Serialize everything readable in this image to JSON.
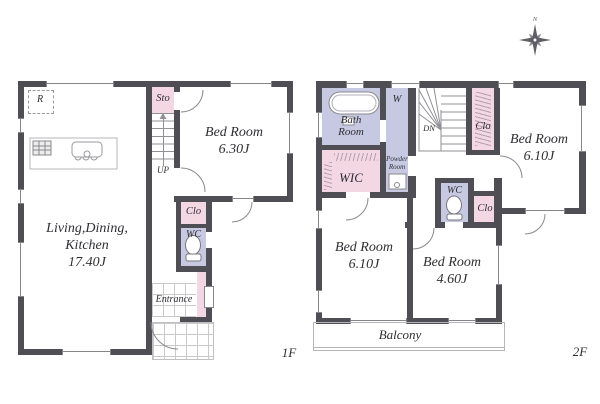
{
  "f1": {
    "floor_label": "1F",
    "ldk_line1": "Living,Dining,",
    "ldk_line2": "Kitchen",
    "ldk_size": "17.40J",
    "bedroom_name": "Bed Room",
    "bedroom_size": "6.30J",
    "sto": "Sto",
    "up": "UP",
    "clo": "Clo",
    "wc": "WC",
    "entrance": "Entrance",
    "fridge": "R"
  },
  "f2": {
    "floor_label": "2F",
    "bath_line1": "Bath",
    "bath_line2": "Room",
    "washer": "W",
    "powder_line1": "Powder",
    "powder_line2": "Room",
    "wic": "WIC",
    "dn": "DN",
    "clo_top": "Clo",
    "clo_mid": "Clo",
    "wc": "WC",
    "bedroom_ne_name": "Bed Room",
    "bedroom_ne_size": "6.10J",
    "bedroom_sw_name": "Bed Room",
    "bedroom_sw_size": "6.10J",
    "bedroom_se_name": "Bed Room",
    "bedroom_se_size": "4.60J",
    "balcony": "Balcony"
  },
  "compass": {
    "north": "N"
  },
  "colors": {
    "wall": "#504e55",
    "pink": "#f3d7e3",
    "lavender": "#c6c9e1"
  }
}
